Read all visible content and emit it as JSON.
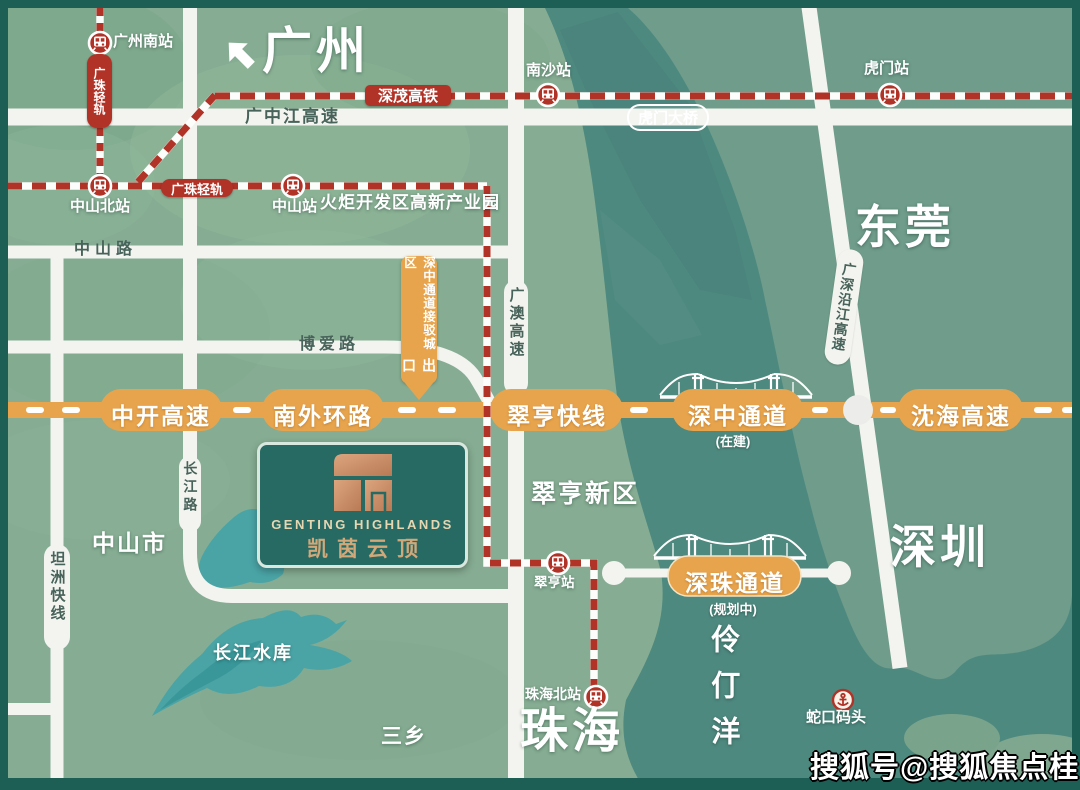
{
  "cities": {
    "guangzhou": "广州",
    "dongguan": "东莞",
    "shenzhen": "深圳",
    "zhuhai": "珠海",
    "zhongshan_city": "中山市",
    "sanxiang": "三乡"
  },
  "areas": {
    "cuiheng_new_district": "翠亨新区",
    "lingdingyang": "伶仃洋",
    "torch_park": "火炬开发区高新产业园",
    "changjiang_reservoir": "长江水库"
  },
  "stations": {
    "guangzhou_south": "广州南站",
    "zhongshan_north": "中山北站",
    "zhongshan": "中山站",
    "nansha": "南沙站",
    "humen": "虎门站",
    "cuiheng": "翠亨站",
    "zhuhai_north": "珠海北站"
  },
  "ports": {
    "shekou": "蛇口码头"
  },
  "rail_lines": {
    "guangzhu_light_rail": "广珠轻轨",
    "shenmao_hsr": "深茂高铁"
  },
  "roads": {
    "guangzhongjiang_expwy": "广中江高速",
    "humen_bridge": "虎门大桥",
    "zhongshan_road": "中山路",
    "boai_road": "博爱路",
    "changjiang_road": "长江路",
    "tanzhou_express": "坦洲快线",
    "guangao_expwy": "广澳高速",
    "guangshen_yanjiang_expwy": "广深沿江高速"
  },
  "expressway_bar": {
    "zhongkai": "中开高速",
    "nanwai_ring": "南外环路",
    "cuiheng_line": "翠亨快线",
    "shenzhong_corridor": "深中通道",
    "shenzhong_status": "(在建)",
    "shenhai": "沈海高速"
  },
  "shenzhu_corridor": {
    "label": "深珠通道",
    "status": "(规划中)"
  },
  "exit_banner": {
    "text": "深中通道接驳城区",
    "exit": "出口"
  },
  "project": {
    "name_en": "GENTING HIGHLANDS",
    "name_cn": "凯茵云顶"
  },
  "watermark": "搜狐号@搜狐焦点桂林站",
  "colors": {
    "land_west": "#86ad93",
    "land_east": "#6f9c8b",
    "water": "#4e897f",
    "road_white": "#f3f4ef",
    "highway_orange": "#e8a44c",
    "rail_red": "#b13327",
    "frame_dark": "#1d5f55",
    "lake_teal": "#4aa4a6",
    "logo_bg": "#266a63",
    "logo_copper": "#c98a64"
  }
}
